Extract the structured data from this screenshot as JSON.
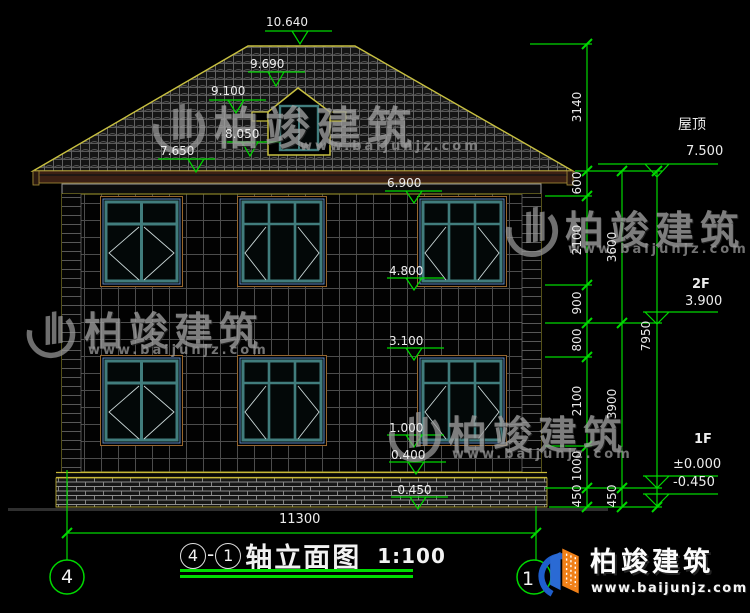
{
  "title_block": {
    "axis_start": "4",
    "separator": "-",
    "axis_end": "1",
    "name": "轴立面图",
    "scale": "1:100"
  },
  "elevation_labels": {
    "ridge": "10.640",
    "dormer_peak": "9.690",
    "dormer_mid": "9.100",
    "dormer_base": "8.050",
    "eave_gutter": "7.650",
    "f2_window_top": "6.900",
    "f2_window_bottom": "4.800",
    "f1_window_top": "3.100",
    "f1_window_bottom": "1.000",
    "plinth_top": "0.400",
    "ground": "-0.450"
  },
  "right_levels": {
    "roof_label": "屋顶",
    "roof_value": "7.500",
    "f2_label": "2F",
    "f2_value": "3.900",
    "f1_label": "1F",
    "f1_value": "±0.000",
    "ground_value": "-0.450"
  },
  "dim_chain_inner": [
    "3140",
    "600",
    "2100",
    "900",
    "800",
    "2100",
    "1000",
    "450"
  ],
  "dim_chain_mid": [
    "3600",
    "3900",
    "450"
  ],
  "dim_chain_outer": [
    "7950"
  ],
  "dim_overall": "11300",
  "grid_bubbles": {
    "left": "4",
    "right": "1"
  },
  "watermark": {
    "text": "柏竣建筑",
    "url": "www.baijunjz.com"
  },
  "logo": {
    "text": "柏竣建筑",
    "url": "www.baijunjz.com"
  },
  "colors": {
    "dimension_green": "#00d800",
    "outline_yellow": "#b8b030",
    "window_teal": "#417d7d",
    "window_trim": "#96662e",
    "window_accent": "#5b86c0",
    "plinth_yellow": "#c8b838",
    "logo_blue": "#2a6ad4",
    "logo_orange": "#f08018"
  }
}
